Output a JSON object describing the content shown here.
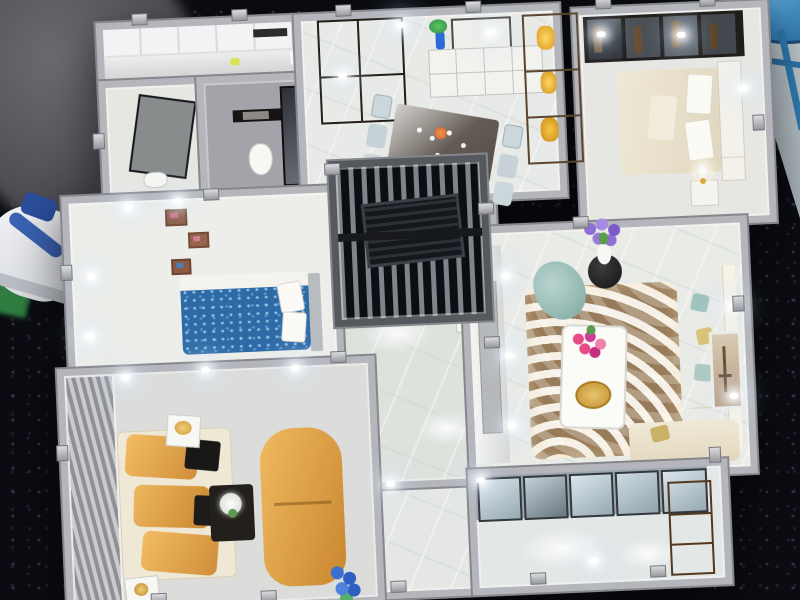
{
  "meta": {
    "description": "Photograph of a miniature apartment scale model (dollhouse-style sales model) seen from above, lit with tiny LED lights, standing on a black sequined exhibition table. A visitor's leg and white sneaker appear at the top left, a green chair behind them, and a blue stool on grey floor at the top right."
  },
  "palette": {
    "table_black": "#0a0c12",
    "sequin_sparkle": "#8c6e8c",
    "wall_grey": "#b4b6bb",
    "wall_edge": "#85878c",
    "floor_marble": "#e9ebe7",
    "hall_floor": "#dde2dd",
    "bed_blue": "#2e6ba6",
    "sofa_cream": "#ece4cf",
    "sofa_gold": "#e2a84f",
    "pillow_black": "#1b1a19",
    "rug_brown": "#b99d79",
    "armchair_teal": "#9cc2bd",
    "wood_brown": "#8a6c4e",
    "door_brown": "#3e342c",
    "stool_blue": "#2f7db6",
    "chair_green": "#3da353",
    "flower_pink": "#e84a86",
    "flower_purple": "#8f6fd6",
    "flower_blue": "#3b6fd0"
  },
  "rooms": [
    {
      "id": "kitchen",
      "label": "Kitchen - white cabinets, counter with miniature bottles and range hood"
    },
    {
      "id": "shower-room",
      "label": "Small bathroom - glass partition and washbasin"
    },
    {
      "id": "bathroom",
      "label": "Bathroom - white toilet, black towel rail, smoked-glass shower screen"
    },
    {
      "id": "dining-foyer",
      "label": "Entry and dining room - dark brown front door, white sideboard with blue vase and picture frame, glass dining table with six pale chairs"
    },
    {
      "id": "display-shelf",
      "label": "Wooden display shelf with gold vases beside the entry"
    },
    {
      "id": "bedroom-guest",
      "label": "Guest bedroom - glass-front wardrobe, cream bed with tufted headboard, lamp on nightstand"
    },
    {
      "id": "bedroom-main",
      "label": "Main bedroom - sparkling blue bed with white pillows, small picture shelves on the wall"
    },
    {
      "id": "study",
      "label": "Study enclosed by a black slatted screen"
    },
    {
      "id": "hallway",
      "label": "Hallway with polished marble floor and small plant pedestal"
    },
    {
      "id": "living-room",
      "label": "Living room - brown swirl rug, white coffee table with pink flowers, cream corner sofa, teal armchair, purple flowers on a dark pedestal, framed picture on the wall"
    },
    {
      "id": "family-lounge",
      "label": "Second lounge - gold sofa with black pillows, gold chaise, dark coffee table with white flowers, striped grey feature wall"
    },
    {
      "id": "balcony",
      "label": "Balcony - glazed sliding doors, glossy floor, wooden cabinet"
    },
    {
      "id": "passage",
      "label": "Passage with marble floor and blue flowers"
    }
  ],
  "furniture": {
    "entry_door": "Dark brown panelled double entry door",
    "dining_table": "Glass-topped dining table with six chairs and stemware",
    "wardrobe": "Dark glass-front wardrobe with clothes inside",
    "guest_bed": "Cream bed with white tufted headboard",
    "blue_bed": "Sequin-blue double bed",
    "toilet": "White toilet",
    "living_sofa": "Cream L-shaped sofa with teal and gold cushions",
    "rug": "Brown and cream swirl rug",
    "coffee_table": "White coffee table with gold tray and pink flowers",
    "gold_sofa": "Gold satin sofa with black pillows",
    "gold_chaise": "Gold satin chaise lounge",
    "dark_coffee_table": "Dark coffee table with white flowers"
  },
  "props": {
    "table": "Black sequined exhibition table",
    "person_leg": "Visitor's leg in grey trousers",
    "green_chair": "Green chair frame",
    "sneaker": "White sneaker with blue swoosh",
    "blue_stool": "Blue round stool on grey showroom floor",
    "floor": "Grey showroom floor"
  }
}
